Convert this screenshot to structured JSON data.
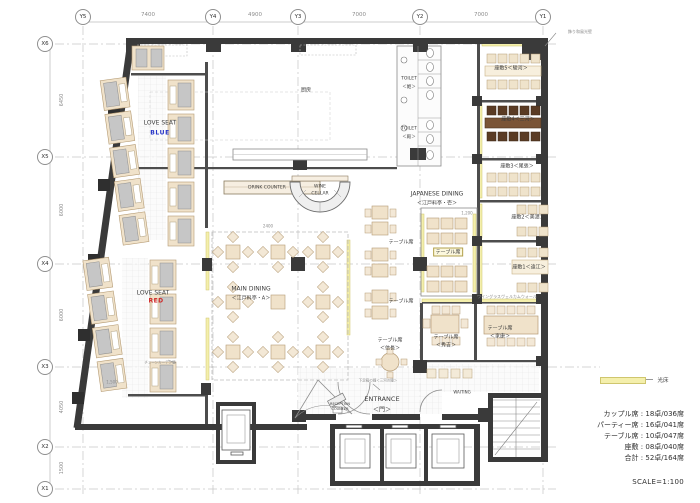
{
  "axes": {
    "top": [
      {
        "label": "Y5"
      },
      {
        "label": "Y4"
      },
      {
        "label": "Y3"
      },
      {
        "label": "Y2"
      },
      {
        "label": "Y1"
      }
    ],
    "top_dims": [
      "7400",
      "4900",
      "7000",
      "7000"
    ],
    "left": [
      {
        "label": "X6"
      },
      {
        "label": "X5"
      },
      {
        "label": "X4"
      },
      {
        "label": "X3"
      },
      {
        "label": "X2"
      },
      {
        "label": "X1"
      }
    ],
    "left_dims": [
      "6450",
      "6000",
      "6000",
      "4050",
      "1500"
    ]
  },
  "rooms": {
    "kitchen": "厨房",
    "drink_counter": "DRINK COUNTER",
    "wine_cellar_1": "WINE",
    "wine_cellar_2": "CELLAR",
    "main_dining_1": "MAIN DINING",
    "main_dining_2": "＜江戸料亭・A＞",
    "japanese_dining_1": "JAPANESE DINING",
    "japanese_dining_2": "＜江戸料亭・壱＞",
    "love_seat_blue_1": "LOVE SEAT",
    "love_seat_blue_2": "BLUE",
    "love_seat_red_1": "LOVE SEAT",
    "love_seat_red_2": "RED",
    "table_a": "テーブル席",
    "table_b": "テーブル席",
    "table_boxed": "テーブル席",
    "table_nobunaga_1": "テーブル席",
    "table_nobunaga_2": "＜信長＞",
    "table_hideyoshi_1": "テーブル席",
    "table_hideyoshi_2": "＜秀吉＞",
    "table_ieyasu_1": "テーブル席",
    "table_ieyasu_2": "＜家康＞",
    "zashiki5": "座敷5＜駿河＞",
    "zashiki4": "座敷4＜三河＞",
    "zashiki3": "座敷3＜尾張＞",
    "zashiki2": "座敷2＜美濃＞",
    "zashiki1": "座敷1＜遠江＞",
    "toilet_hime_1": "TOILET",
    "toilet_hime_2": "＜姫＞",
    "toilet_tono_1": "TOILET",
    "toilet_tono_2": "＜殿＞",
    "entrance_1": "ENTRANCE",
    "entrance_2": "＜門＞",
    "reception_1": "RECEPTION",
    "reception_2": "COUNTER",
    "waiting": "WAITING"
  },
  "annotations": {
    "light_wall": "飾り和風光壁",
    "welcome_wall": "ワイングラスヴェルカムウォール",
    "chain_wall": "チェーンカーテン壁",
    "entrance_bell": "下足箱の鐘＜三河の鐘＞",
    "light_floor": "光床",
    "dim_2400": "2400",
    "dim_1200": "1,200",
    "dim_1500": "1,500"
  },
  "legend": {
    "separator": " : ",
    "rows": [
      {
        "label": "カップル席",
        "value": "18卓/036席"
      },
      {
        "label": "パーティー席",
        "value": "16卓/041席"
      },
      {
        "label": "テーブル席",
        "value": "10卓/047席"
      },
      {
        "label": "座敷",
        "value": "08卓/040席"
      },
      {
        "label": "合計",
        "value": "52卓/164席"
      }
    ],
    "scale": "SCALE=1:100"
  },
  "colors": {
    "wall": "#3a3a3a",
    "table_cream": "#f0e2ca",
    "table_dark": "#5a3b24",
    "seat_gray": "#c6c6c6",
    "light_floor": "#f4efac",
    "blue_label": "#2634c8",
    "red_label": "#cf2626"
  }
}
